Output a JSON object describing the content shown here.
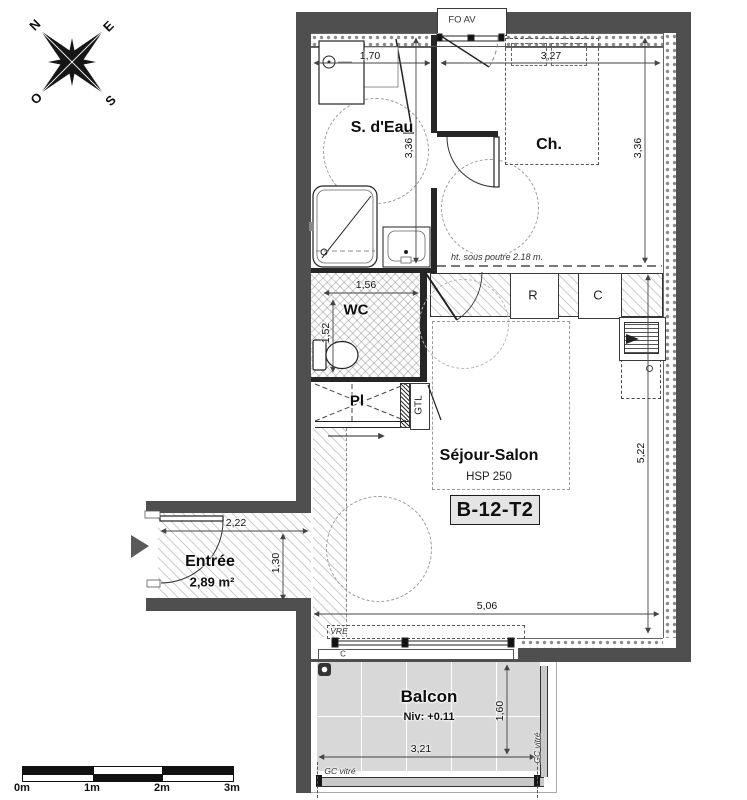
{
  "compass": {
    "n": "N",
    "e": "E",
    "s": "S",
    "o": "O"
  },
  "header": {
    "window_label": "FO AV"
  },
  "rooms": {
    "sdeau": {
      "name": "S. d'Eau"
    },
    "ch": {
      "name": "Ch."
    },
    "wc": {
      "name": "WC"
    },
    "pl": {
      "name": "Pl"
    },
    "gtl": {
      "name": "GTL"
    },
    "sejour": {
      "name": "Séjour-Salon",
      "ceiling": "HSP 250",
      "unit": "B-12-T2",
      "beam_note": "ht. sous poutre 2.18 m."
    },
    "entree": {
      "name": "Entrée",
      "area": "2,89 m²"
    },
    "balcon": {
      "name": "Balcon",
      "level": "Niv: +0.11"
    }
  },
  "kitchen": {
    "fridge": "R",
    "cooking": "C"
  },
  "openings": {
    "bay_label": "C",
    "shutter": "VRE",
    "railing_bottom": "GC vitré",
    "railing_right": "GC vitré"
  },
  "dims": {
    "sdeau_w": "1,70",
    "ch_w": "3,27",
    "sdeau_h": "3,36",
    "ch_h": "3,36",
    "wc_w": "1,56",
    "wc_h": "1,52",
    "sejour_h": "5,22",
    "sejour_w": "5,06",
    "entree_w": "2,22",
    "entree_h": "1,30",
    "balcon_w": "3,21",
    "balcon_h": "1,60"
  },
  "scalebar": {
    "t0": "0m",
    "t1": "1m",
    "t2": "2m",
    "t3": "3m"
  },
  "colors": {
    "wall": "#4f4f4f",
    "accent": "#111111"
  }
}
